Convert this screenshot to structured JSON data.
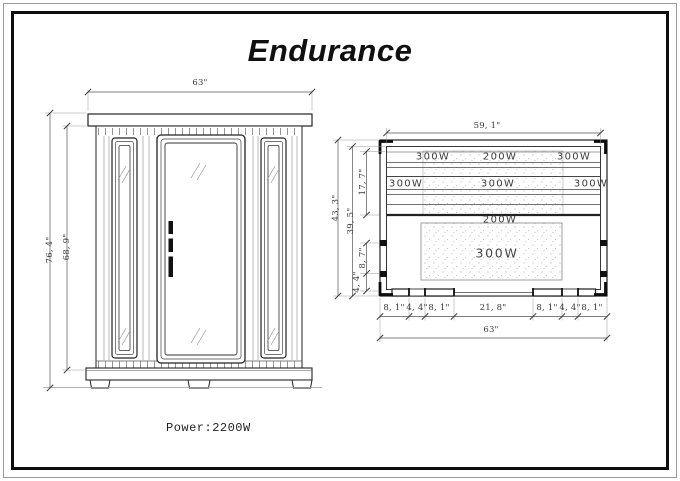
{
  "title": "Endurance",
  "power_note": "Power:2200W",
  "front_view": {
    "dims": {
      "width": "63\"",
      "height_outer": "76, 4\"",
      "height_inner": "68, 9\""
    }
  },
  "top_view": {
    "dims": {
      "inner_width": "59, 1\"",
      "height_outer": "43, 3\"",
      "height_inner": "39, 5\"",
      "bench_depth": "17, 7\"",
      "side_panel": "8, 7\"",
      "side_glass": "4, 4\"",
      "bottom_chain": [
        "8, 1\"",
        "4, 4\"",
        "8, 1\"",
        "21, 8\"",
        "8, 1\"",
        "4, 4\"",
        "8, 1\""
      ],
      "total_width": "63\""
    },
    "heaters": {
      "row1": [
        "300W",
        "200W",
        "300W"
      ],
      "row2": [
        "300W",
        "300W",
        "300W"
      ],
      "row3": "200W",
      "floor": "300W"
    }
  }
}
